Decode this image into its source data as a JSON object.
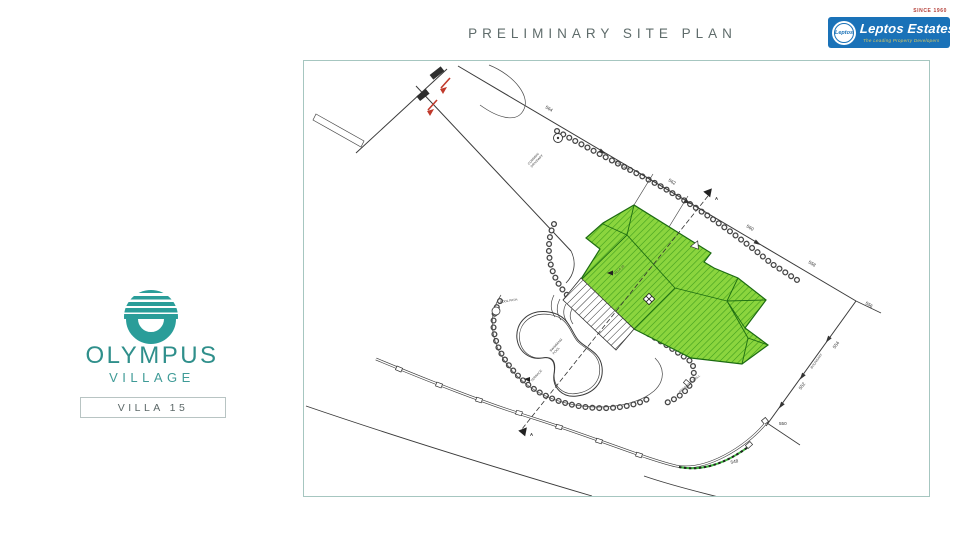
{
  "header": {
    "title": "PRELIMINARY SITE PLAN"
  },
  "brand": {
    "since": "SINCE 1960",
    "name": "Leptos Estates",
    "badge": "Leptos",
    "tagline": "The Leading Property Developers",
    "blue": "#1a72b8"
  },
  "project": {
    "name": "OLYMPUS",
    "subname": "VILLAGE",
    "unit": "VILLA 15",
    "teal": "#2a9d99"
  },
  "plan": {
    "section_marker": "A",
    "contours": [
      "564",
      "562",
      "560",
      "558",
      "556",
      "554",
      "552",
      "550",
      "548"
    ],
    "labels": {
      "pool_path": "POOL PATH",
      "pool_l1": "SWIMMING",
      "pool_l2": "POOL",
      "drive_l1": "COMMON",
      "drive_l2": "DRIVEWAY",
      "house": "VILLA 15",
      "terrace": "TERRACE",
      "wall": "RETAINING WALL",
      "boundary": "BOUNDARY"
    },
    "colors": {
      "roof_green": "#8bd53e",
      "roof_hatch": "#3f9d1c",
      "contour_green": "#3db83d"
    }
  }
}
